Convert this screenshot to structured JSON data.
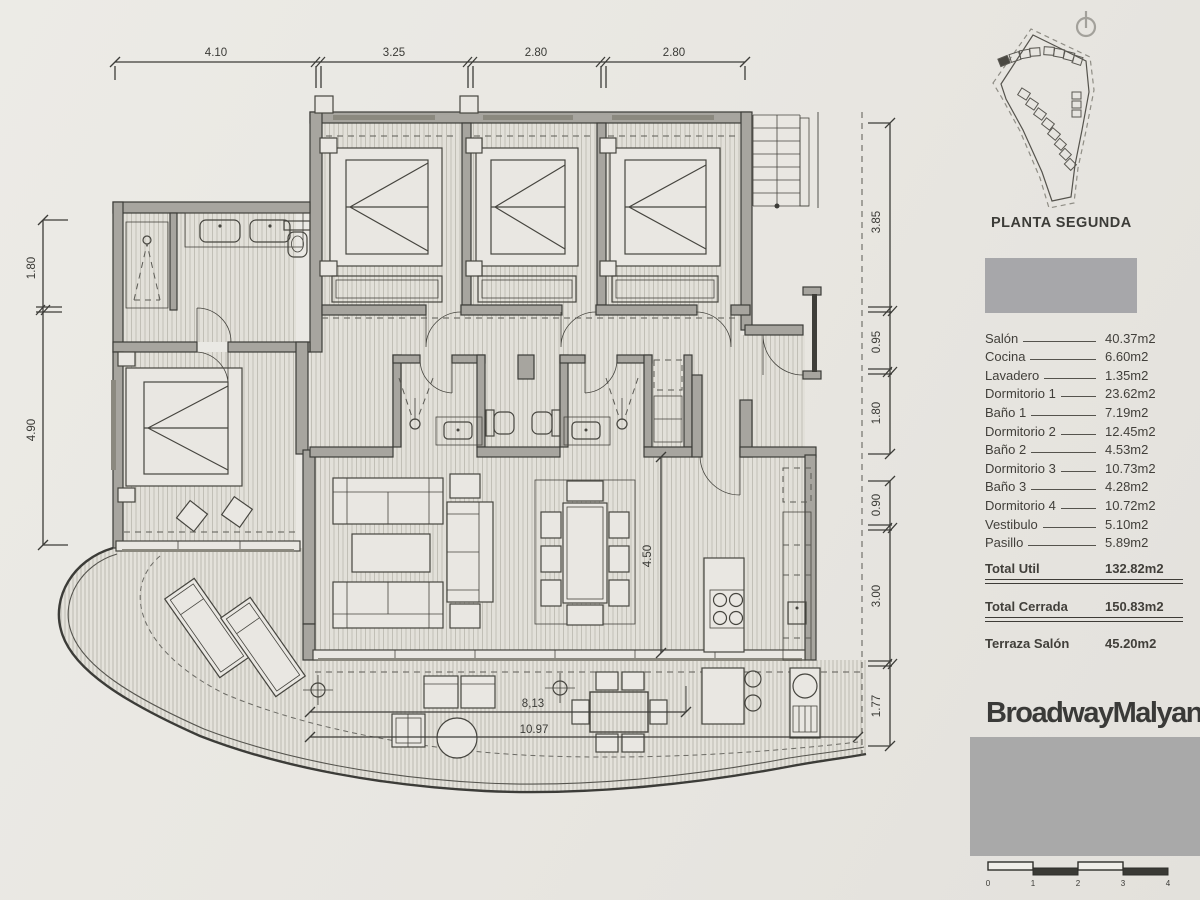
{
  "plan": {
    "dimensions": {
      "top": [
        "4.10",
        "3.25",
        "2.80",
        "2.80"
      ],
      "left": [
        "1.80",
        "4.90"
      ],
      "right_upper": [
        "3.85",
        "0.95",
        "1.80"
      ],
      "right_lower": [
        "0.90",
        "3.00",
        "1.77"
      ],
      "living": "4.50",
      "terrace_a": "8,13",
      "terrace_b": "10.97"
    }
  },
  "site_plan": {
    "title": "PLANTA SEGUNDA"
  },
  "schedule": {
    "rooms": [
      {
        "name": "Salón",
        "area": "40.37m2"
      },
      {
        "name": "Cocina",
        "area": "6.60m2"
      },
      {
        "name": "Lavadero",
        "area": "1.35m2"
      },
      {
        "name": "Dormitorio 1",
        "area": "23.62m2"
      },
      {
        "name": "Baño 1",
        "area": "7.19m2"
      },
      {
        "name": "Dormitorio 2",
        "area": "12.45m2"
      },
      {
        "name": "Baño 2",
        "area": "4.53m2"
      },
      {
        "name": "Dormitorio 3",
        "area": "10.73m2"
      },
      {
        "name": "Baño 3",
        "area": "4.28m2"
      },
      {
        "name": "Dormitorio 4",
        "area": "10.72m2"
      },
      {
        "name": "Vestibulo",
        "area": "5.10m2"
      },
      {
        "name": "Pasillo",
        "area": "5.89m2"
      }
    ],
    "total_util": {
      "name": "Total Util",
      "area": "132.82m2"
    },
    "total_cerrada": {
      "name": "Total Cerrada",
      "area": "150.83m2"
    },
    "terraza": {
      "name": "Terraza Salón",
      "area": "45.20m2"
    }
  },
  "branding": {
    "logo_text": "BroadwayMalyan",
    "logo_mark": "B"
  },
  "scale_bar": {
    "labels": [
      "0",
      "1",
      "2",
      "3",
      "4"
    ]
  },
  "colors": {
    "paper": "#e8e6e1",
    "wall": "#a7a59f",
    "line": "#3c3c38",
    "redacted": "#a8a8ab"
  }
}
